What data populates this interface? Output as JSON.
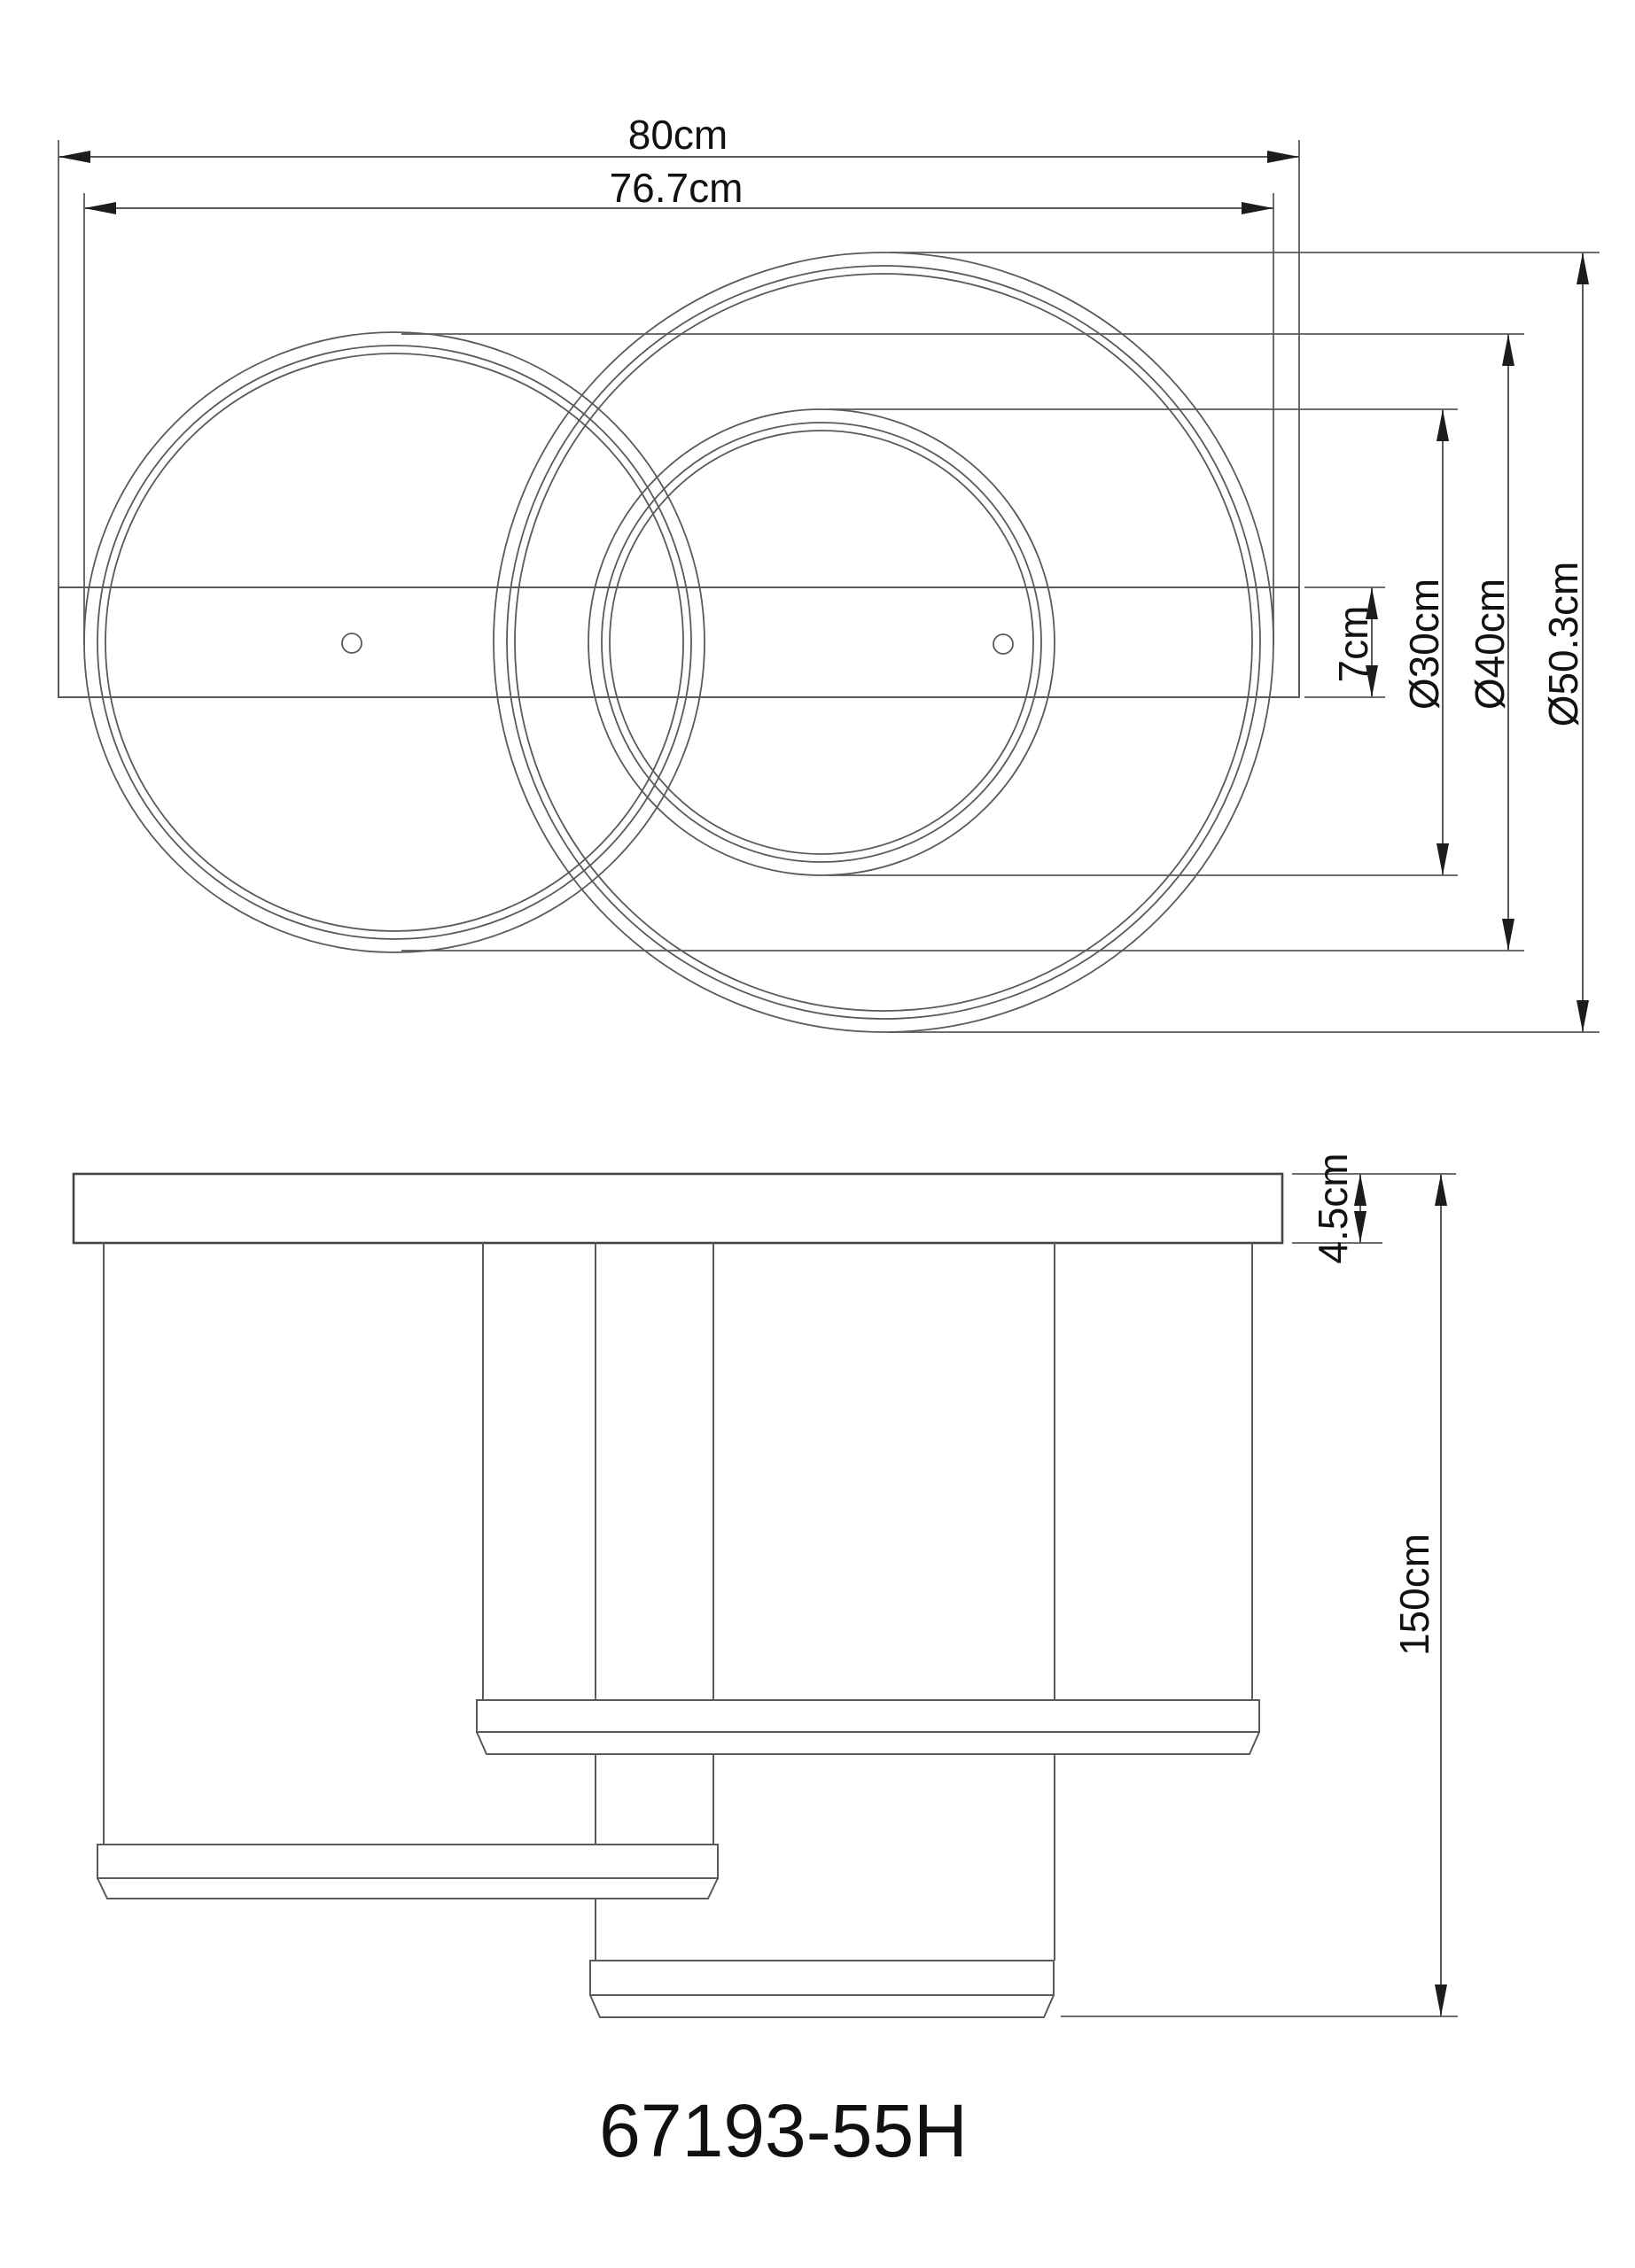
{
  "drawing": {
    "model_number": "67193-55H",
    "top_view": {
      "overall_width_label": "80cm",
      "ring_span_label": "76.7cm",
      "bar_height_label": "7cm",
      "ring_small_label": "Ø30cm",
      "ring_medium_label": "Ø40cm",
      "ring_large_label": "Ø50.3cm"
    },
    "side_view": {
      "canopy_height_label": "4.5cm",
      "total_height_label": "150cm"
    },
    "colors": {
      "line": "#5a5a5a",
      "heavy_line": "#454545",
      "text": "#111111",
      "arrow": "#1c1c1c",
      "background": "#ffffff"
    }
  }
}
